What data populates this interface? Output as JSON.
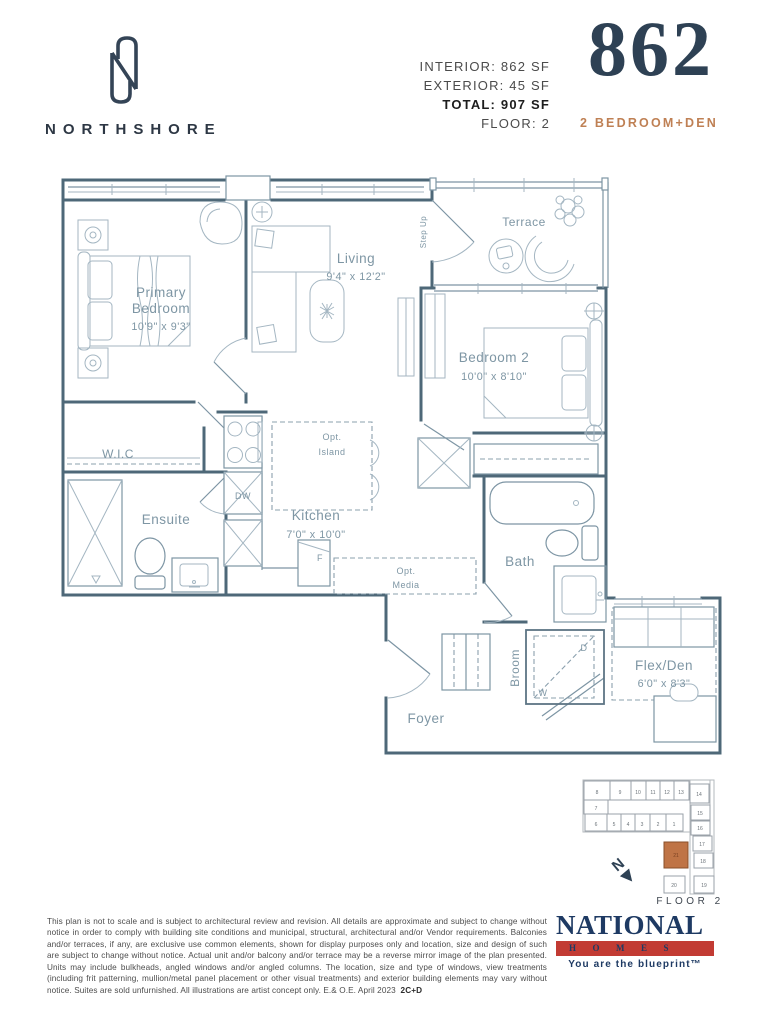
{
  "header": {
    "brand_name": "NORTHSHORE",
    "stats": [
      {
        "text": "INTERIOR: 862 SF"
      },
      {
        "text": "EXTERIOR: 45 SF"
      },
      {
        "text": "TOTAL: 907 SF"
      },
      {
        "text": "FLOOR:  2"
      }
    ],
    "unit": {
      "number": "862",
      "type": "2 BEDROOM+DEN"
    }
  },
  "plan": {
    "primary_bedroom": {
      "l1": "Primary",
      "l2": "Bedroom",
      "dims": "10'9\" x 9'3\""
    },
    "living": {
      "name": "Living",
      "dims": "9'4\" x 12'2\""
    },
    "terrace": "Terrace",
    "step_up": "Step Up",
    "bedroom2": {
      "name": "Bedroom 2",
      "dims": "10'0\" x 8'10\""
    },
    "wic": "W.I.C",
    "ensuite": "Ensuite",
    "kitchen": {
      "name": "Kitchen",
      "dims": "7'0\" x 10'0\""
    },
    "opt_island": {
      "l1": "Opt.",
      "l2": "Island"
    },
    "opt_media": {
      "l1": "Opt.",
      "l2": "Media"
    },
    "dw": "DW",
    "f": "F",
    "bath": "Bath",
    "broom": "Broom",
    "wd_d": "D",
    "wd_w": "W",
    "flex_den": {
      "name": "Flex/Den",
      "dims": "6'0\" x 8'3\""
    },
    "foyer": "Foyer"
  },
  "keyplate": {
    "units": [
      "1",
      "2",
      "3",
      "4",
      "5",
      "6",
      "7",
      "8",
      "9",
      "10",
      "11",
      "12",
      "13",
      "14",
      "15",
      "16",
      "17",
      "18",
      "19",
      "20",
      "21"
    ],
    "highlighted_unit": "21",
    "north_label": "N",
    "floor_label": "FLOOR 2"
  },
  "footer": {
    "disclaimer": "This plan is not to scale and is subject to architectural review and revision. All details are approximate and subject to change without notice in order to comply with building site conditions and municipal, structural, architectural and/or Vendor requirements. Balconies and/or terraces, if any, are exclusive use common elements, shown for display purposes only and location, size and design of such are subject to change without notice. Actual unit and/or balcony and/or terrace may be a reverse mirror image of the plan presented. Units may include bulkheads, angled windows and/or angled columns. The location, size and type of windows, view treatments (including frit patterning, mullion/metal panel placement or other visual treatments) and exterior building elements may vary without notice. Suites are sold unfurnished. All illustrations are artist concept only. E.& O.E. April 2023",
    "plan_code": "2C+D",
    "logo": {
      "name": "NATIONAL",
      "homes": "HOMES",
      "tagline": "You are the blueprint™"
    }
  },
  "colors": {
    "brand_navy": "#2e4154",
    "accent_copper": "#bf8054",
    "plan_wall": "#4e6878",
    "plan_line": "#7d95a4",
    "plan_text": "#7e96a4",
    "keyplate_highlight": "#bf7446",
    "logo_navy": "#1e3a63",
    "logo_red": "#c23b33"
  }
}
